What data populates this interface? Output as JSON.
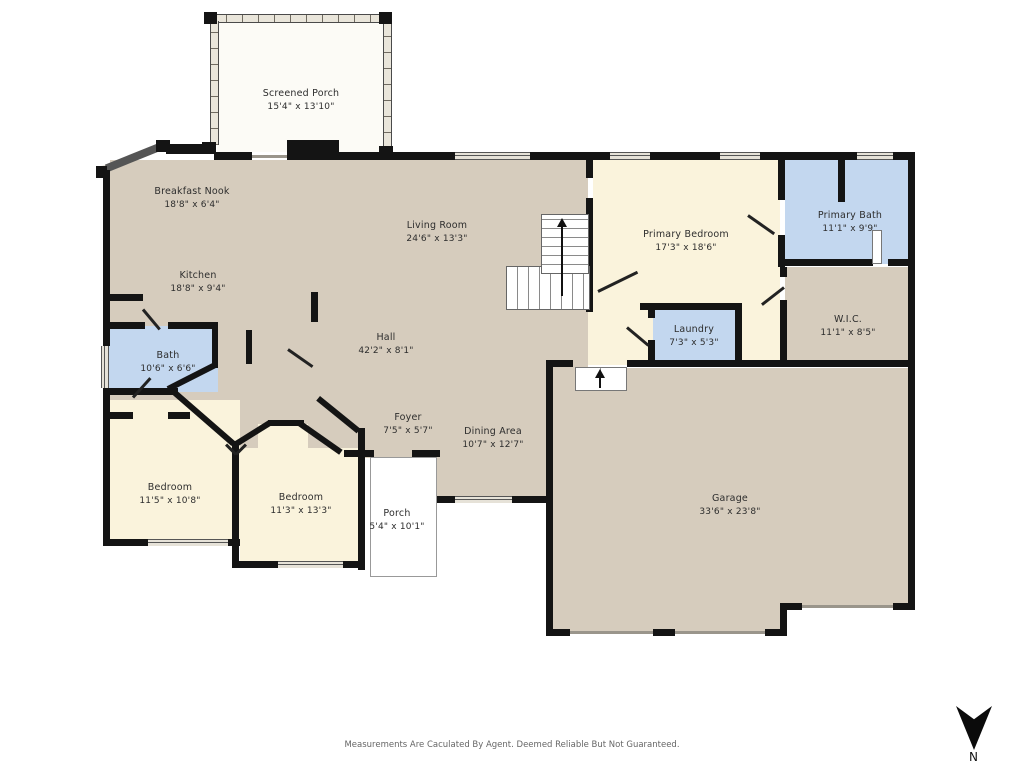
{
  "palette": {
    "wall": "#141414",
    "floor_tan": "#d6ccbd",
    "floor_cream": "#faf3dc",
    "floor_blue": "#c3d7ef",
    "porch_white": "#ffffff"
  },
  "rooms": [
    {
      "id": "screened-porch",
      "name": "Screened Porch",
      "dims": "15'4\" x 13'10\""
    },
    {
      "id": "breakfast-nook",
      "name": "Breakfast Nook",
      "dims": "18'8\" x 6'4\""
    },
    {
      "id": "living-room",
      "name": "Living Room",
      "dims": "24'6\" x 13'3\""
    },
    {
      "id": "primary-bedroom",
      "name": "Primary Bedroom",
      "dims": "17'3\" x 18'6\""
    },
    {
      "id": "primary-bath",
      "name": "Primary Bath",
      "dims": "11'1\" x 9'9\""
    },
    {
      "id": "kitchen",
      "name": "Kitchen",
      "dims": "18'8\" x 9'4\""
    },
    {
      "id": "bath",
      "name": "Bath",
      "dims": "10'6\" x 6'6\""
    },
    {
      "id": "hall",
      "name": "Hall",
      "dims": "42'2\" x 8'1\""
    },
    {
      "id": "laundry",
      "name": "Laundry",
      "dims": "7'3\" x 5'3\""
    },
    {
      "id": "wic",
      "name": "W.I.C.",
      "dims": "11'1\" x 8'5\""
    },
    {
      "id": "foyer",
      "name": "Foyer",
      "dims": "7'5\" x 5'7\""
    },
    {
      "id": "dining-area",
      "name": "Dining Area",
      "dims": "10'7\" x 12'7\""
    },
    {
      "id": "bedroom-1",
      "name": "Bedroom",
      "dims": "11'5\" x 10'8\""
    },
    {
      "id": "bedroom-2",
      "name": "Bedroom",
      "dims": "11'3\" x 13'3\""
    },
    {
      "id": "porch",
      "name": "Porch",
      "dims": "5'4\" x 10'1\""
    },
    {
      "id": "garage",
      "name": "Garage",
      "dims": "33'6\" x 23'8\""
    }
  ],
  "compass": {
    "label": "N"
  },
  "footer": {
    "disclaimer": "Measurements Are Caculated By Agent. Deemed Reliable But Not Guaranteed."
  }
}
